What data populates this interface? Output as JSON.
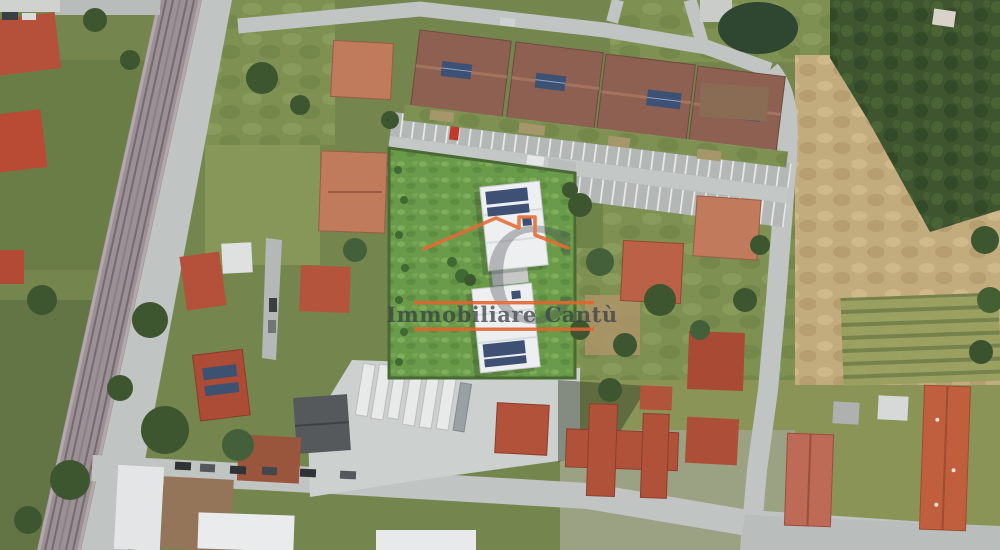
{
  "image": {
    "kind": "aerial satellite photograph (real-estate listing)",
    "scene": "Residential neighborhood: railway line and service road on the west, rendered new-build plot with two white solar-roof buildings on bright green grass in the center, row houses with a striped parking strip to the north, vacant tan field and dense trees to the east, truck yard and red-roofed houses to the south",
    "width_px": 1000,
    "height_px": 550
  },
  "watermark": {
    "name": "Immobiliare Cantù",
    "monogram": "C",
    "roof_color": "#e66a33",
    "line_color": "#e7622c",
    "text_color": "#3a4046",
    "monogram_color": "#3f464c"
  },
  "palette": {
    "vegetation_base": "#75854e",
    "lawn": "#7e9152",
    "render_grass": "#6a9b4b",
    "trees_dark": "#3d5630",
    "field_tan": "#c2ab7d",
    "road": "#c0c4c3",
    "railway": "#9c9097",
    "concrete_yard": "#ccd0cf",
    "roof_red": "#b5503a",
    "roof_salmon": "#c07a5c",
    "townhouse_roof": "#8d6051",
    "solar_panel": "#3e5174",
    "new_building_white": "#edeff0",
    "trailer_white": "#e8eaea"
  }
}
